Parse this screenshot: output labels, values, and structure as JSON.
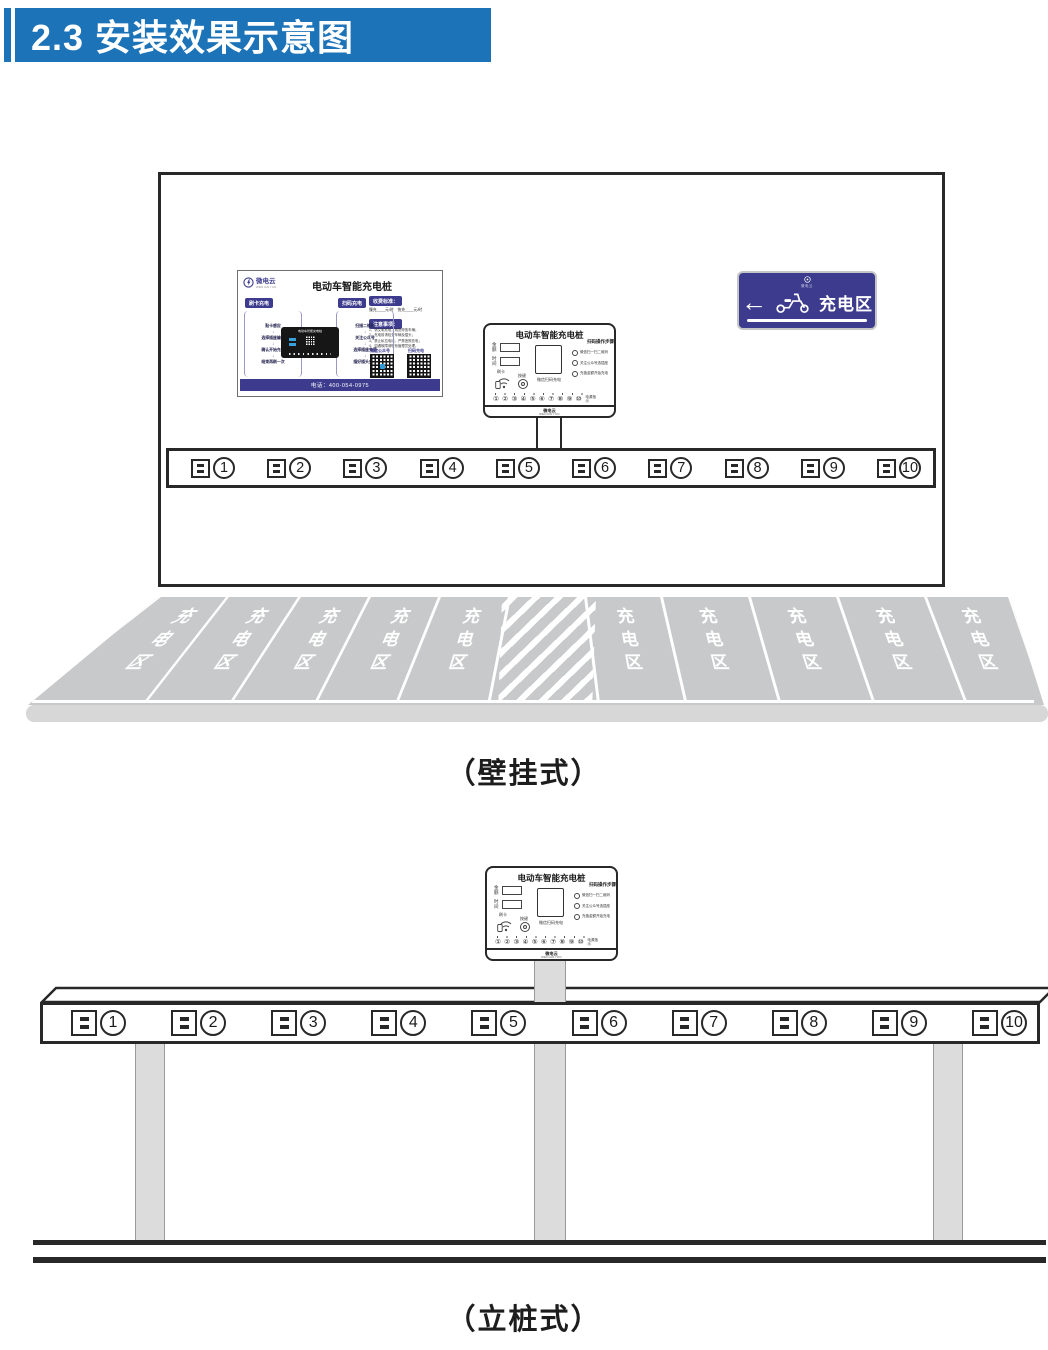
{
  "header": {
    "title": "2.3 安装效果示意图"
  },
  "captions": {
    "wall": "（壁挂式）",
    "pole": "（立桩式）"
  },
  "poster": {
    "logo": "微电云",
    "logo_sub": "WEDIANYUN",
    "title": "电动车智能充电桩",
    "badge_card": "刷卡充电",
    "badge_scan": "扫码充电",
    "badge_price": "收费标准：",
    "badge_notice": "注意事项：",
    "price_line": "慢充____元/时　快充____元/时",
    "notices": [
      "1、请文明充电，规范停放车辆；",
      "2、充电前请检查车辆及插头；",
      "3、禁止私拉电线，严禁违规充电；",
      "4、如遇故障请联系管理员处理。"
    ],
    "card_steps": [
      "贴卡感应",
      "选择插座编号",
      "确认开始充电",
      "结束再刷一次"
    ],
    "scan_steps": [
      "扫描二维码",
      "关注公众号",
      "选择插座充值",
      "插好插头充电"
    ],
    "arrow": "↓",
    "qr_left_label": "微信公众号",
    "qr_right_label": "扫码充电",
    "photo_title": "电动车智能充电桩",
    "hotline": "电话：400-054-0975"
  },
  "sign": {
    "logo": "微电云",
    "arrow": "←",
    "label": "充电区"
  },
  "device": {
    "title": "电动车智能充电桩",
    "display_labels": [
      "金额",
      "时间"
    ],
    "icon_labels": [
      "刷卡",
      "按键"
    ],
    "qr_caption": "微信扫码充电",
    "steps_title": "扫码操作步骤",
    "steps": [
      "微信扫一扫二维码",
      "关注公众号选插座",
      "充值金额开始充电"
    ],
    "ports": "① ② ③ ④ ⑤ ⑥ ⑦ ⑧ ⑨ ⑩",
    "ports_caption": "电源指示",
    "brand": "微电云",
    "brand_sub": "WEDIANYUN"
  },
  "sockets": {
    "numbers": [
      "1",
      "2",
      "3",
      "4",
      "5",
      "6",
      "7",
      "8",
      "9",
      "10"
    ]
  },
  "parking": {
    "label": "充电区"
  }
}
